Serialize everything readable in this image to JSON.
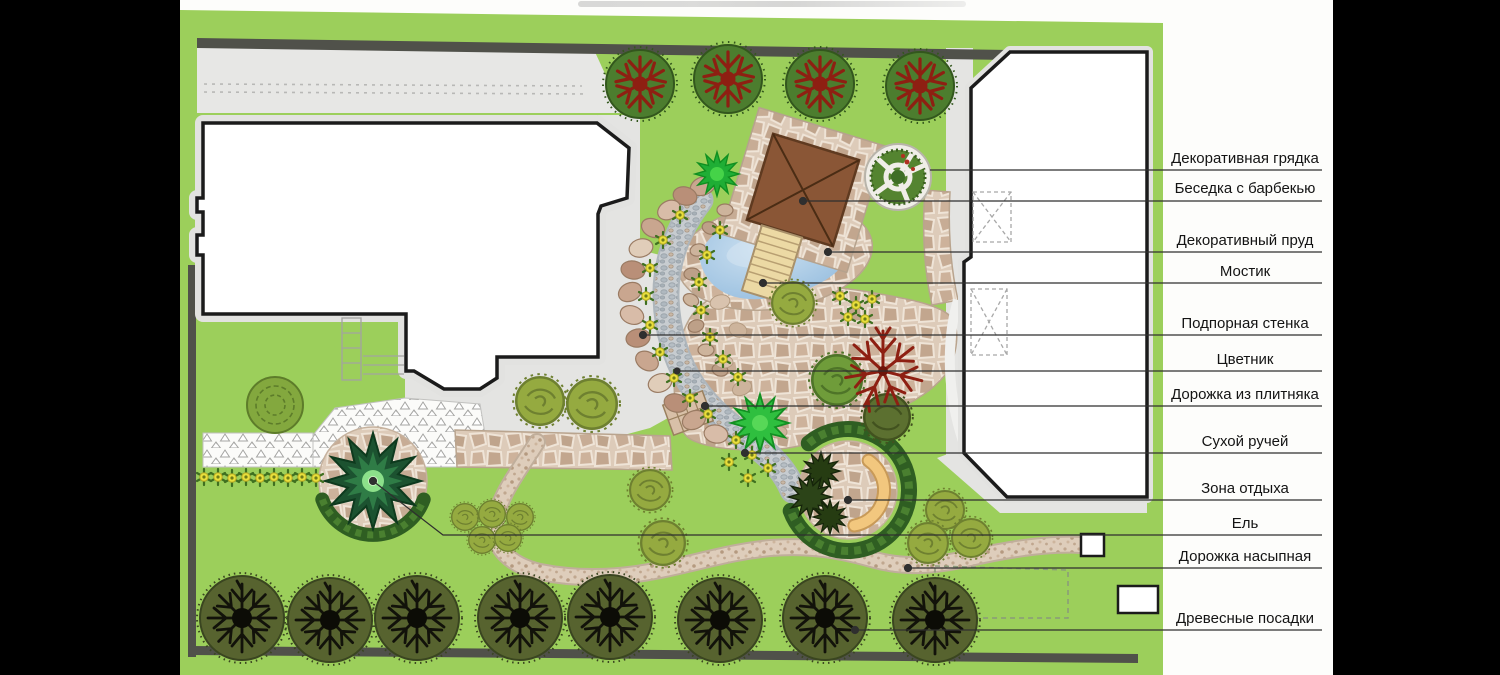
{
  "plan": {
    "legend": {
      "items": [
        {
          "text": "Декоративная грядка"
        },
        {
          "text": "Беседка с барбекью"
        },
        {
          "text": "Декоративный пруд"
        },
        {
          "text": "Мостик"
        },
        {
          "text": "Подпорная стенка"
        },
        {
          "text": "Цветник"
        },
        {
          "text": "Дорожка из плитняка"
        },
        {
          "text": "Сухой ручей"
        },
        {
          "text": "Зона отдыха"
        },
        {
          "text": "Ель"
        },
        {
          "text": "Дорожка насыпная"
        },
        {
          "text": "Древесные посадки"
        }
      ]
    },
    "colors": {
      "lawn": "#9CCF5B",
      "flagstone": "#CDB8A3",
      "pond": "#A9C9E6",
      "gazebo": "#8A5636",
      "fence": "#50514A",
      "hedge": "#2F5E22",
      "bench": "#F2C77E"
    }
  }
}
